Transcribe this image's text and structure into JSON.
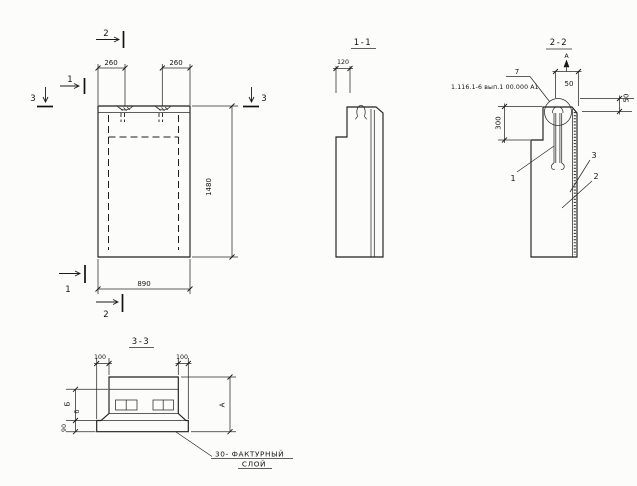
{
  "drawing": {
    "front_view": {
      "marker_top_2": "2",
      "marker_top_1": "1",
      "marker_left_3": "3",
      "marker_right_3": "3",
      "marker_bottom_1": "1",
      "marker_bottom_2": "2",
      "dim_260_left": "260",
      "dim_260_right": "260",
      "dim_1480": "1480",
      "dim_890": "890"
    },
    "section_1_1": {
      "title": "1-1",
      "dim_120": "120"
    },
    "section_2_2": {
      "title": "2-2",
      "view_mark": "А",
      "dim_50_top": "50",
      "dim_50_right": "50",
      "dim_300": "300",
      "detail_number": "7",
      "detail_ref": "1.116.1-6 вып.1 00.000 А1",
      "pos_1": "1",
      "pos_2": "2",
      "pos_3": "3"
    },
    "section_3_3": {
      "title": "3-3",
      "dim_100_left": "100",
      "dim_100_right": "100",
      "dim_B": "Б",
      "dim_b": "б",
      "dim_90": "90",
      "dim_A": "А",
      "note_line1": "30- ФАКТУРНЫЙ",
      "note_line2": "СЛОЙ"
    },
    "ink_color": "#1e1e1e",
    "paper_color": "#fcfcfa"
  }
}
